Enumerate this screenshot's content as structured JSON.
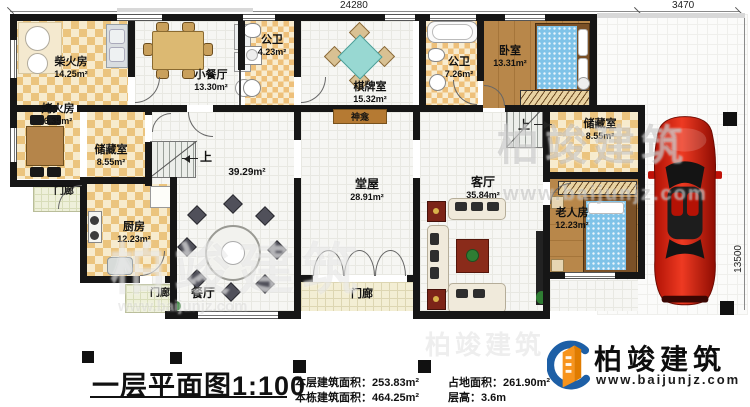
{
  "dims": {
    "main": "24280",
    "side": "3470",
    "height": "13500"
  },
  "stairs_up": "上",
  "rooms": {
    "chaihuofang": {
      "name": "柴火房",
      "area": "14.25m²"
    },
    "kaohuofang": {
      "name": "烤火房",
      "area": "6.35m²"
    },
    "chucang_left": {
      "name": "储藏室",
      "area": "8.55m²"
    },
    "menlang_left": {
      "name": "门廊"
    },
    "chufang": {
      "name": "厨房",
      "area": "12.23m²"
    },
    "menlang_sw": {
      "name": "门廊"
    },
    "canting": {
      "name": "餐厅"
    },
    "xiaocanting": {
      "name": "小餐厅",
      "area": "13.30m²"
    },
    "gongwei1": {
      "name": "公卫",
      "area": "4.23m²"
    },
    "qipaishi": {
      "name": "棋牌室",
      "area": "15.32m²"
    },
    "gongwei2": {
      "name": "公卫",
      "area": "7.26m²"
    },
    "woshi": {
      "name": "卧室",
      "area": "13.31m²"
    },
    "shenkan": {
      "name": "神龛"
    },
    "chucang_right": {
      "name": "储藏室",
      "area": "8.55m²"
    },
    "tangwu": {
      "name": "堂屋",
      "area": "28.91m²"
    },
    "keting": {
      "name": "客厅",
      "area": "35.84m²"
    },
    "laorenfang": {
      "name": "老人房",
      "area": "12.23m²"
    },
    "menlang_center": {
      "name": "门廊"
    },
    "hall": {
      "area": "39.29m²"
    }
  },
  "footer": {
    "title": "一层平面图1:100",
    "stats": [
      {
        "label": "本层建筑面积：",
        "value": "253.83m²"
      },
      {
        "label": "本栋建筑面积：",
        "value": "464.25m²"
      },
      {
        "label": "占地面积：",
        "value": "261.90m²"
      },
      {
        "label": "层高：",
        "value": "3.6m"
      }
    ],
    "brand_name": "柏竣建筑",
    "brand_url": "www.baijunjz.com"
  },
  "watermark": {
    "name": "柏竣建筑",
    "url": "www.baijunjz.com"
  },
  "colors": {
    "wall": "#161616",
    "checker_dark": "#ebc47e",
    "checker_light": "#f7ebcd",
    "wood": "#b8874a",
    "table_teal": "#98d8d2",
    "car_red": "#d41b0c",
    "brand_blue": "#1d5fa6",
    "brand_orange": "#f7941d"
  }
}
